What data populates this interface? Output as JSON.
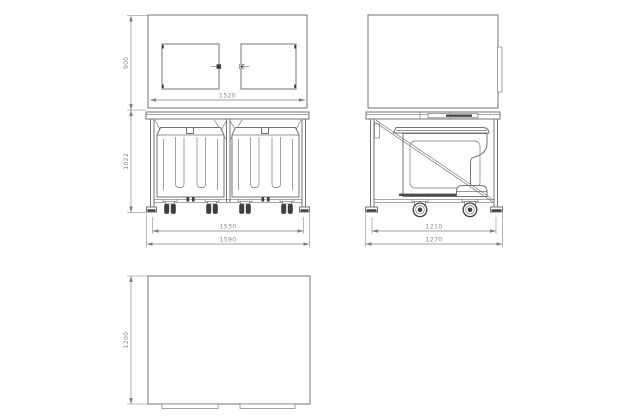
{
  "drawing_title": "wheeled-bin-cabinet-technical-drawing",
  "views": {
    "front": {
      "label": "front-view",
      "dims": {
        "cabinet_height": "900",
        "frame_height": "1022",
        "cabinet_width": "1520",
        "track_width": "1530",
        "overall_width": "1590"
      }
    },
    "side": {
      "label": "side-view",
      "dims": {
        "frame_depth": "1210",
        "overall_depth": "1270"
      }
    },
    "plan": {
      "label": "plan-view",
      "dims": {
        "depth": "1200"
      }
    }
  },
  "colors": {
    "background": "#ffffff",
    "line": "#737373",
    "dark": "#3f3f3f",
    "dim_line": "#7f7f7f",
    "dim_text": "#8a8a8a"
  }
}
